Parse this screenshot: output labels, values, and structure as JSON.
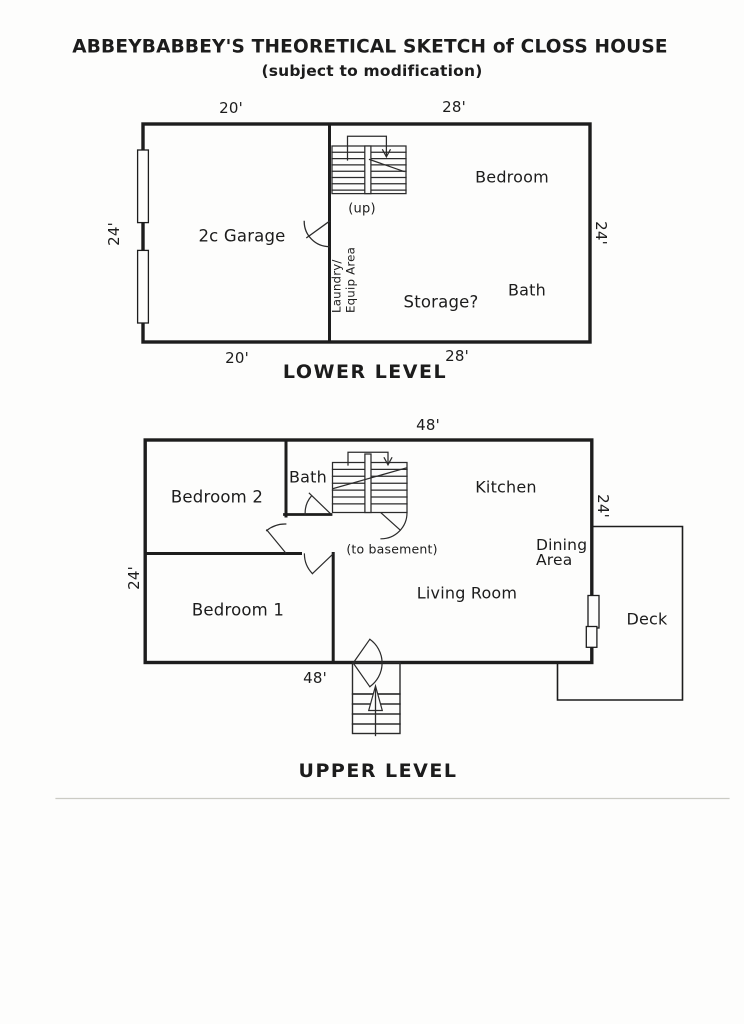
{
  "page": {
    "title": "ABBEYBABBEY'S THEORETICAL SKETCH of CLOSS HOUSE",
    "subtitle": "(subject to modification)"
  },
  "colors": {
    "ink": "#1d1d1d",
    "paper": "#fdfdfc"
  },
  "lower_level": {
    "caption": "LOWER LEVEL",
    "dimensions": {
      "top_left": "20'",
      "top_right": "28'",
      "bottom_left": "20'",
      "bottom_right": "28'",
      "left_side": "24'",
      "right_side": "24'"
    },
    "rooms": {
      "garage": "2c Garage",
      "bedroom": "Bedroom",
      "bath": "Bath",
      "storage": "Storage?"
    },
    "laundry": {
      "line1": "Laundry/",
      "line2": "Equip Area"
    },
    "stairs_note": "(up)"
  },
  "upper_level": {
    "caption": "UPPER LEVEL",
    "dimensions": {
      "top": "48'",
      "bottom": "48'",
      "left_side": "24'",
      "right_side": "24'"
    },
    "rooms": {
      "bedroom2": "Bedroom 2",
      "bath": "Bath",
      "kitchen": "Kitchen",
      "living_room": "Living Room",
      "bedroom1": "Bedroom 1",
      "deck": "Deck"
    },
    "dining": {
      "line1": "Dining",
      "line2": "Area"
    },
    "stairs_note": "(to basement)"
  }
}
